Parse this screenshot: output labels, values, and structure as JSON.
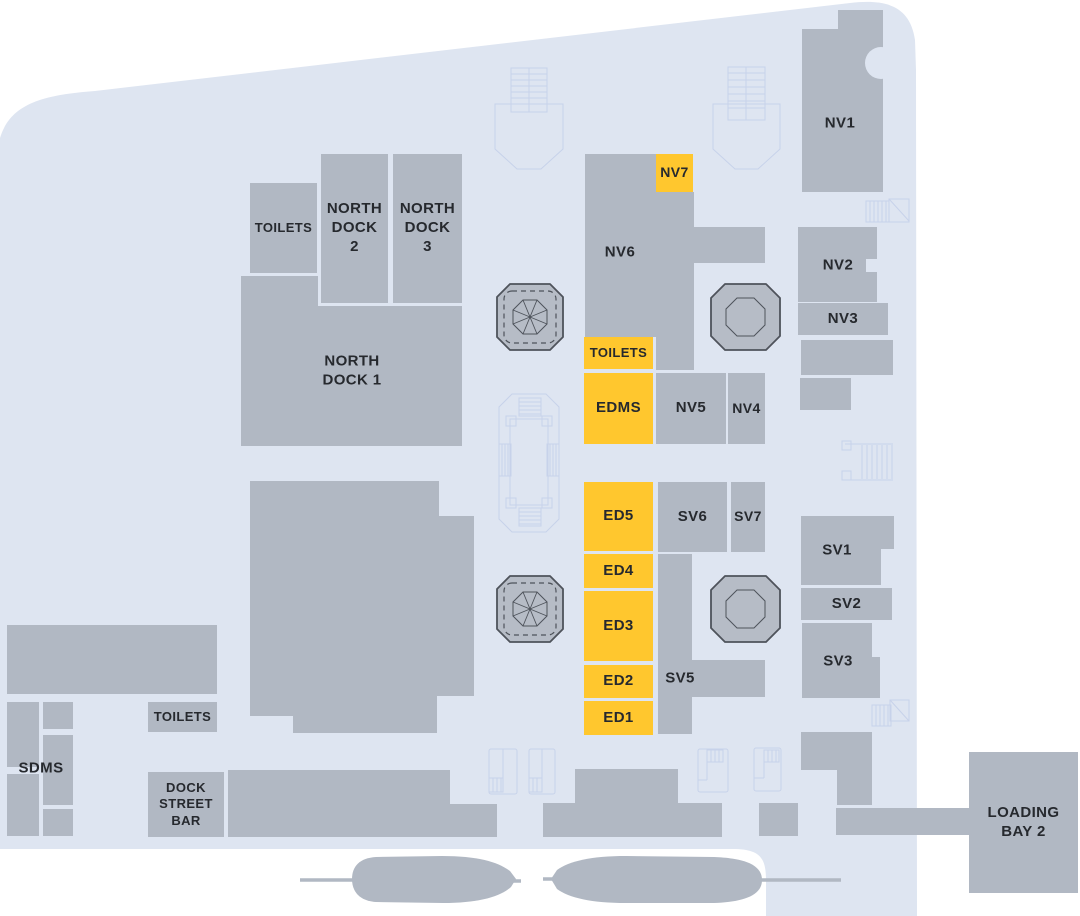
{
  "colors": {
    "page_bg": "#ffffff",
    "floor": "#dee5f1",
    "block": "#b1b8c3",
    "highlight": "#ffc72e",
    "feature_fill": "#b6bcc6",
    "feature_outline": "#4e535b",
    "text": "#26292e",
    "decoration_line": "#c7d2ea"
  },
  "rooms": {
    "toilets_north": {
      "label": "TOILETS",
      "highlighted": false
    },
    "north_dock_2": {
      "label": "NORTH\nDOCK\n2",
      "highlighted": false
    },
    "north_dock_3": {
      "label": "NORTH\nDOCK\n3",
      "highlighted": false
    },
    "north_dock_1": {
      "label": "NORTH\nDOCK 1",
      "highlighted": false
    },
    "nv1": {
      "label": "NV1",
      "highlighted": false
    },
    "nv2": {
      "label": "NV2",
      "highlighted": false
    },
    "nv3": {
      "label": "NV3",
      "highlighted": false
    },
    "nv4": {
      "label": "NV4",
      "highlighted": false
    },
    "nv5": {
      "label": "NV5",
      "highlighted": false
    },
    "nv6": {
      "label": "NV6",
      "highlighted": false
    },
    "nv7": {
      "label": "NV7",
      "highlighted": true
    },
    "toilets_mid": {
      "label": "TOILETS",
      "highlighted": true
    },
    "edms": {
      "label": "EDMS",
      "highlighted": true
    },
    "ed5": {
      "label": "ED5",
      "highlighted": true
    },
    "ed4": {
      "label": "ED4",
      "highlighted": true
    },
    "ed3": {
      "label": "ED3",
      "highlighted": true
    },
    "ed2": {
      "label": "ED2",
      "highlighted": true
    },
    "ed1": {
      "label": "ED1",
      "highlighted": true
    },
    "sv1": {
      "label": "SV1",
      "highlighted": false
    },
    "sv2": {
      "label": "SV2",
      "highlighted": false
    },
    "sv3": {
      "label": "SV3",
      "highlighted": false
    },
    "sv5": {
      "label": "SV5",
      "highlighted": false
    },
    "sv6": {
      "label": "SV6",
      "highlighted": false
    },
    "sv7": {
      "label": "SV7",
      "highlighted": false
    },
    "sdms": {
      "label": "SDMS",
      "highlighted": false
    },
    "toilets_south": {
      "label": "TOILETS",
      "highlighted": false
    },
    "dock_street_bar": {
      "label": "DOCK\nSTREET\nBAR",
      "highlighted": false
    },
    "loading_bay_2": {
      "label": "LOADING\nBAY 2",
      "highlighted": false
    }
  }
}
